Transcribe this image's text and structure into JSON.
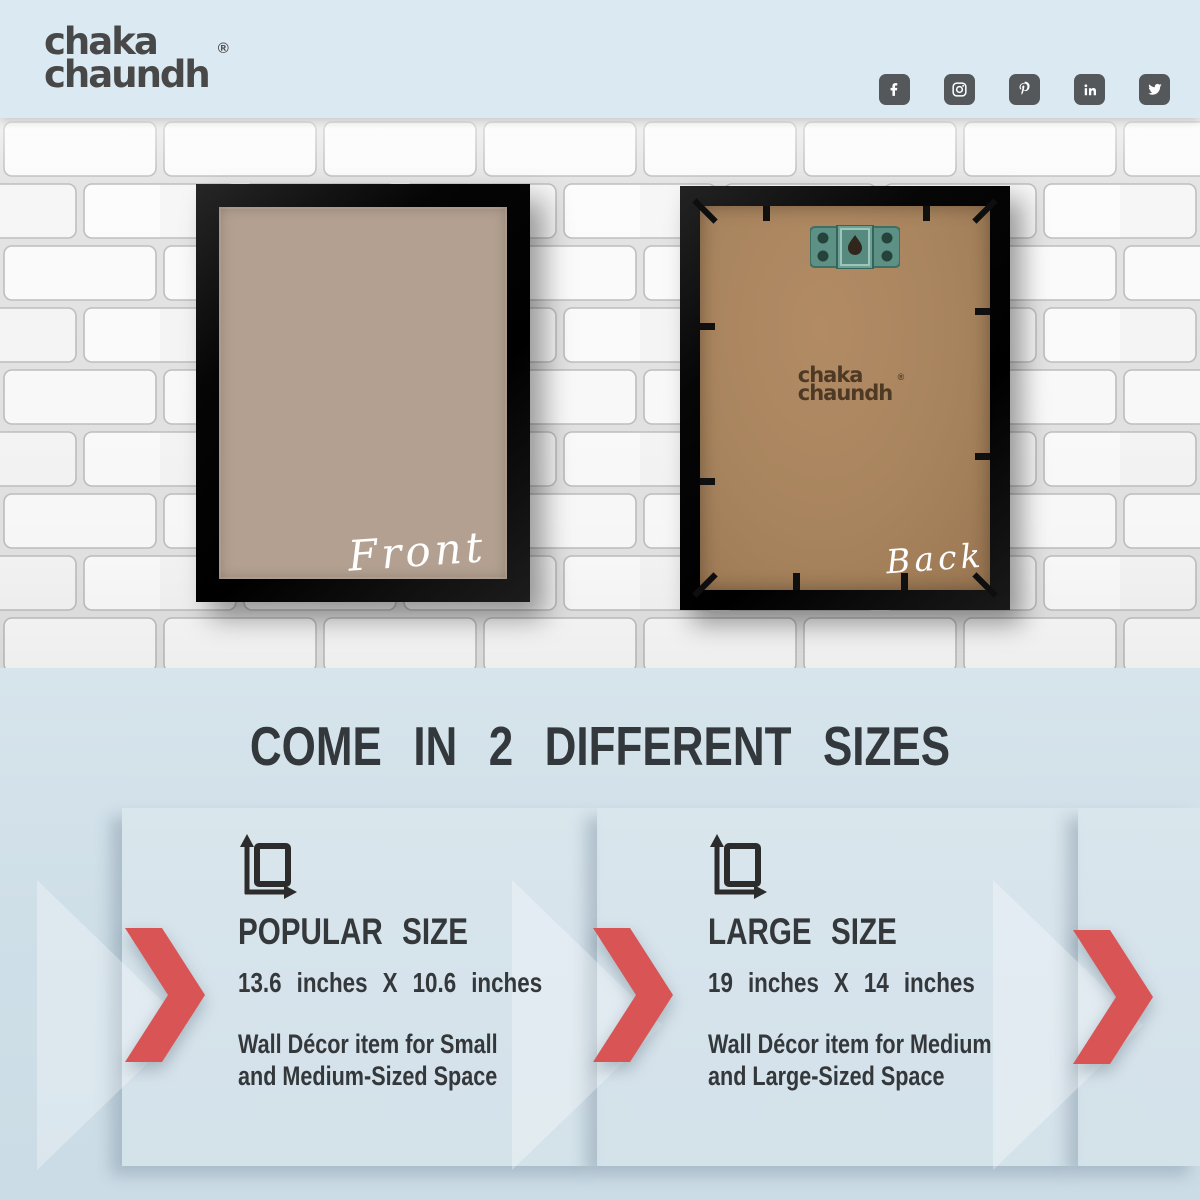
{
  "brand": {
    "logo_line1": "chaka",
    "logo_line2": "chaundh",
    "registered": "®"
  },
  "header": {
    "social_icons": [
      {
        "name": "facebook"
      },
      {
        "name": "instagram"
      },
      {
        "name": "pinterest"
      },
      {
        "name": "linkedin"
      },
      {
        "name": "twitter"
      }
    ]
  },
  "wall": {
    "front_label": "Front",
    "back_label": "Back",
    "back_stamp_line1": "chaka",
    "back_stamp_line2": "chaundh",
    "back_stamp_registered": "®"
  },
  "sizes_section": {
    "heading": "COME IN 2 DIFFERENT SIZES",
    "options": [
      {
        "title": "POPULAR SIZE",
        "dimensions": "13.6 inches  X  10.6 inches",
        "description_line1": "Wall Décor item for Small",
        "description_line2": "and Medium-Sized Space"
      },
      {
        "title": "LARGE SIZE",
        "dimensions": "19 inches  X  14  inches",
        "description_line1": "Wall Décor item for Medium",
        "description_line2": "and Large-Sized Space"
      }
    ]
  },
  "colors": {
    "accent_red": "#d95454",
    "top_bar_blue": "#dbeaf2",
    "bottom_blue": "#cfdfe8",
    "text_dark": "#33383c",
    "frame_black": "#0d0d0d",
    "mat_beige": "#b3a090",
    "board_brown": "#a8845e",
    "hook_teal": "#5d9186",
    "social_icon_gray": "#54585a"
  }
}
